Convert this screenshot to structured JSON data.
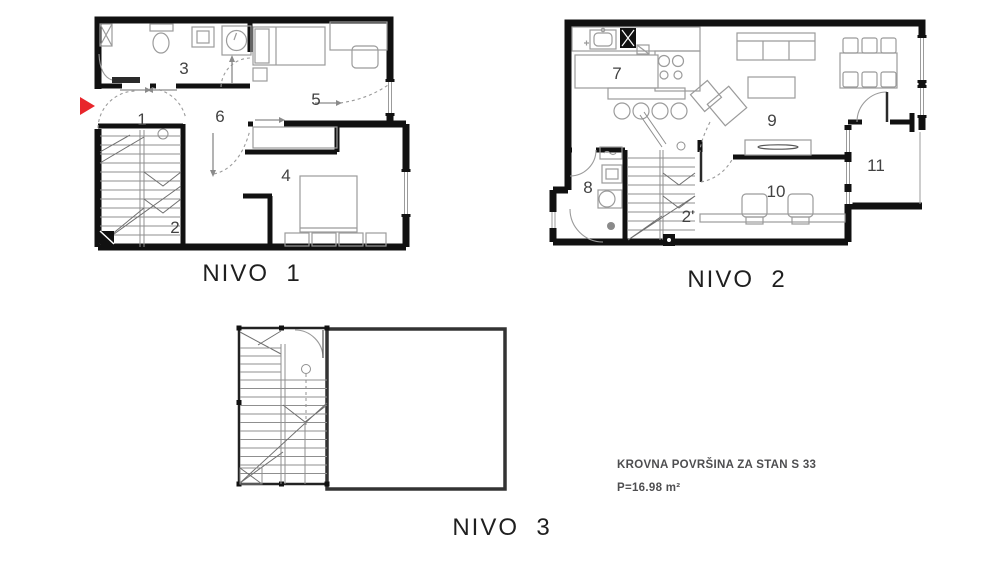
{
  "document": {
    "type": "apartment floor plan sheet",
    "unit": "STAN S 33"
  },
  "colors": {
    "background": "#ffffff",
    "wall": "#111111",
    "furniture": "#9b9b9b",
    "entrance_arrow": "#e8262c",
    "label_text": "#1f1f1f",
    "annotation_text": "#4e4e50"
  },
  "icons": {
    "entrance_arrow": "red right-pointing triangle marking apartment entrance"
  },
  "levels": {
    "nivo1": {
      "label": "NIVO  1",
      "rooms": {
        "r1": "1",
        "r2": "2",
        "r3": "3",
        "r4": "4",
        "r5": "5",
        "r6": "6"
      }
    },
    "nivo2": {
      "label": "NIVO  2",
      "rooms": {
        "r7": "7",
        "r8": "8",
        "r9": "9",
        "r10": "10",
        "r2p": "2'",
        "r11": "11"
      }
    },
    "nivo3": {
      "label": "NIVO  3",
      "rooms": {}
    }
  },
  "annotation": {
    "title": "KROVNA POVRŠINA ZA STAN S 33",
    "area": "P=16.98 m²"
  }
}
